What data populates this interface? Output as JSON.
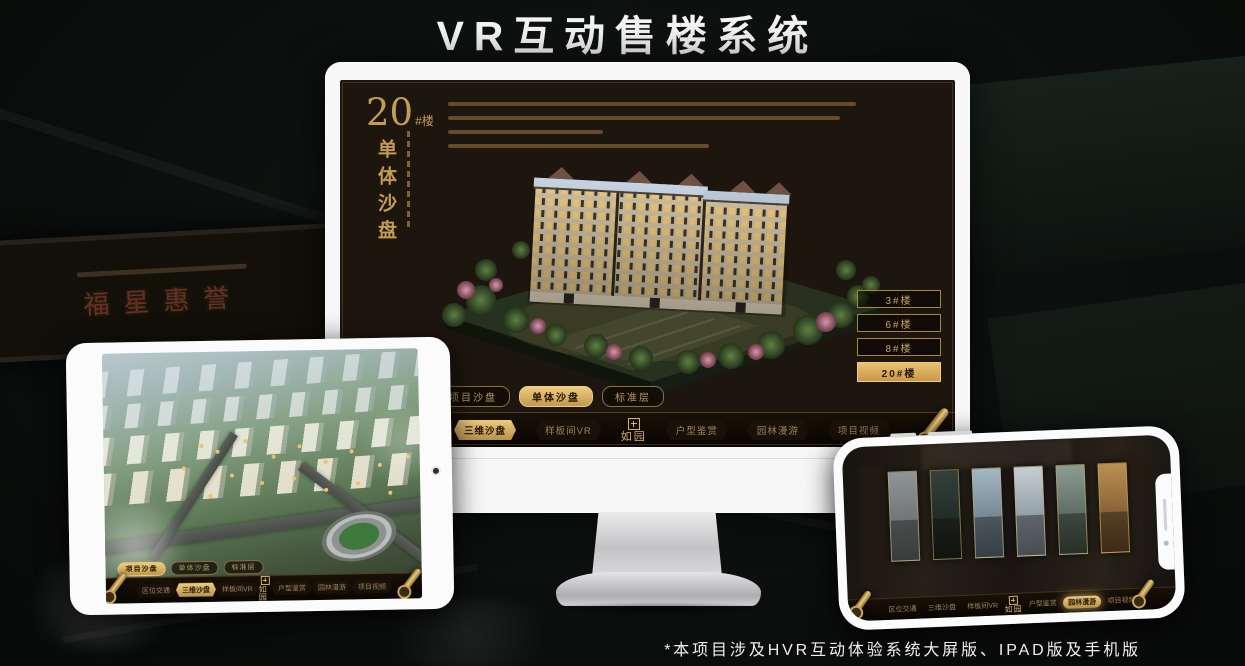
{
  "page": {
    "title": "VR互动售楼系统",
    "footnote": "*本项目涉及HVR互动体验系统大屏版、IPAD版及手机版"
  },
  "background": {
    "plaque_text": "福星惠誉"
  },
  "app": {
    "logo": "如园",
    "menu": [
      "区位交通",
      "三维沙盘",
      "样板间VR",
      "户型鉴赏",
      "园林漫游",
      "项目视频"
    ],
    "tabs": [
      "项目沙盘",
      "单体沙盘",
      "标准层"
    ]
  },
  "monitor": {
    "heading": {
      "number": "20",
      "unit": "#楼",
      "title": "单体沙盘"
    },
    "floor_buttons": [
      {
        "label": "3#楼",
        "active": false
      },
      {
        "label": "6#楼",
        "active": false
      },
      {
        "label": "8#楼",
        "active": false
      },
      {
        "label": "20#楼",
        "active": true
      }
    ],
    "active_tab": "单体沙盘",
    "active_menu": "三维沙盘"
  },
  "ipad": {
    "active_tab": "项目沙盘",
    "active_menu": "三维沙盘"
  },
  "phone": {
    "active_menu": "园林漫游",
    "gallery_panel_count": 6
  },
  "colors": {
    "gold": "#d2a75c",
    "gold_deep": "#a8813c",
    "screen_bg": "#1d160e",
    "title_white": "#f4f4f4"
  }
}
